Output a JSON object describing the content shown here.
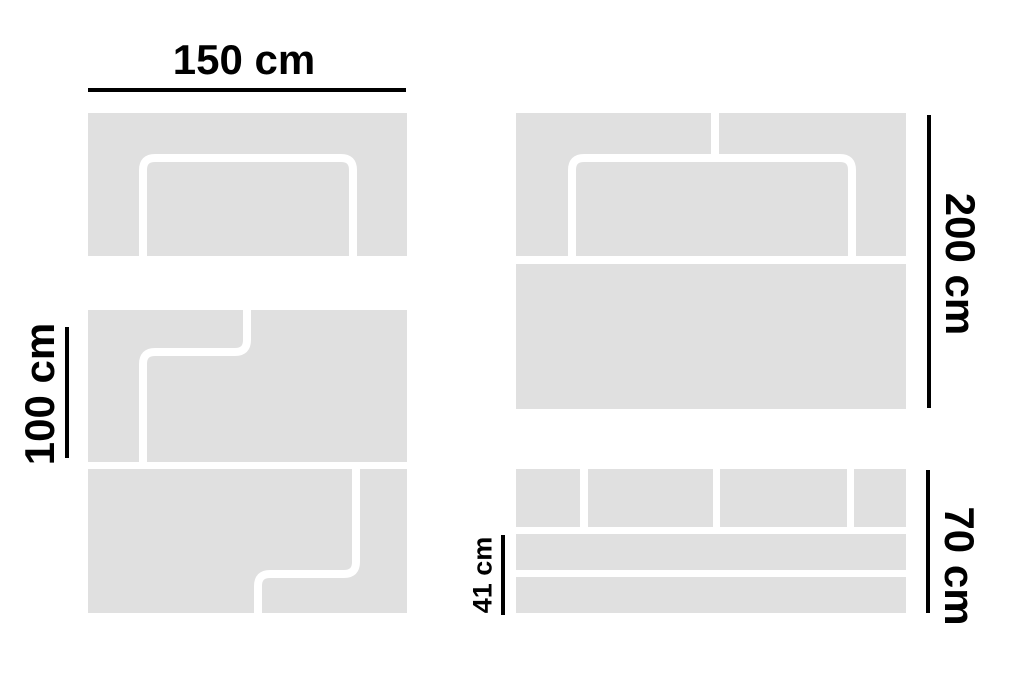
{
  "colors": {
    "background": "#ffffff",
    "panel": "#e0e0e0",
    "cut_line": "#ffffff",
    "dimension": "#000000"
  },
  "dimensions": {
    "top_width": "150 cm",
    "left_height": "100 cm",
    "right_height": "200 cm",
    "bottom_right_height": "70 cm",
    "bottom_strip_height": "41 cm"
  }
}
